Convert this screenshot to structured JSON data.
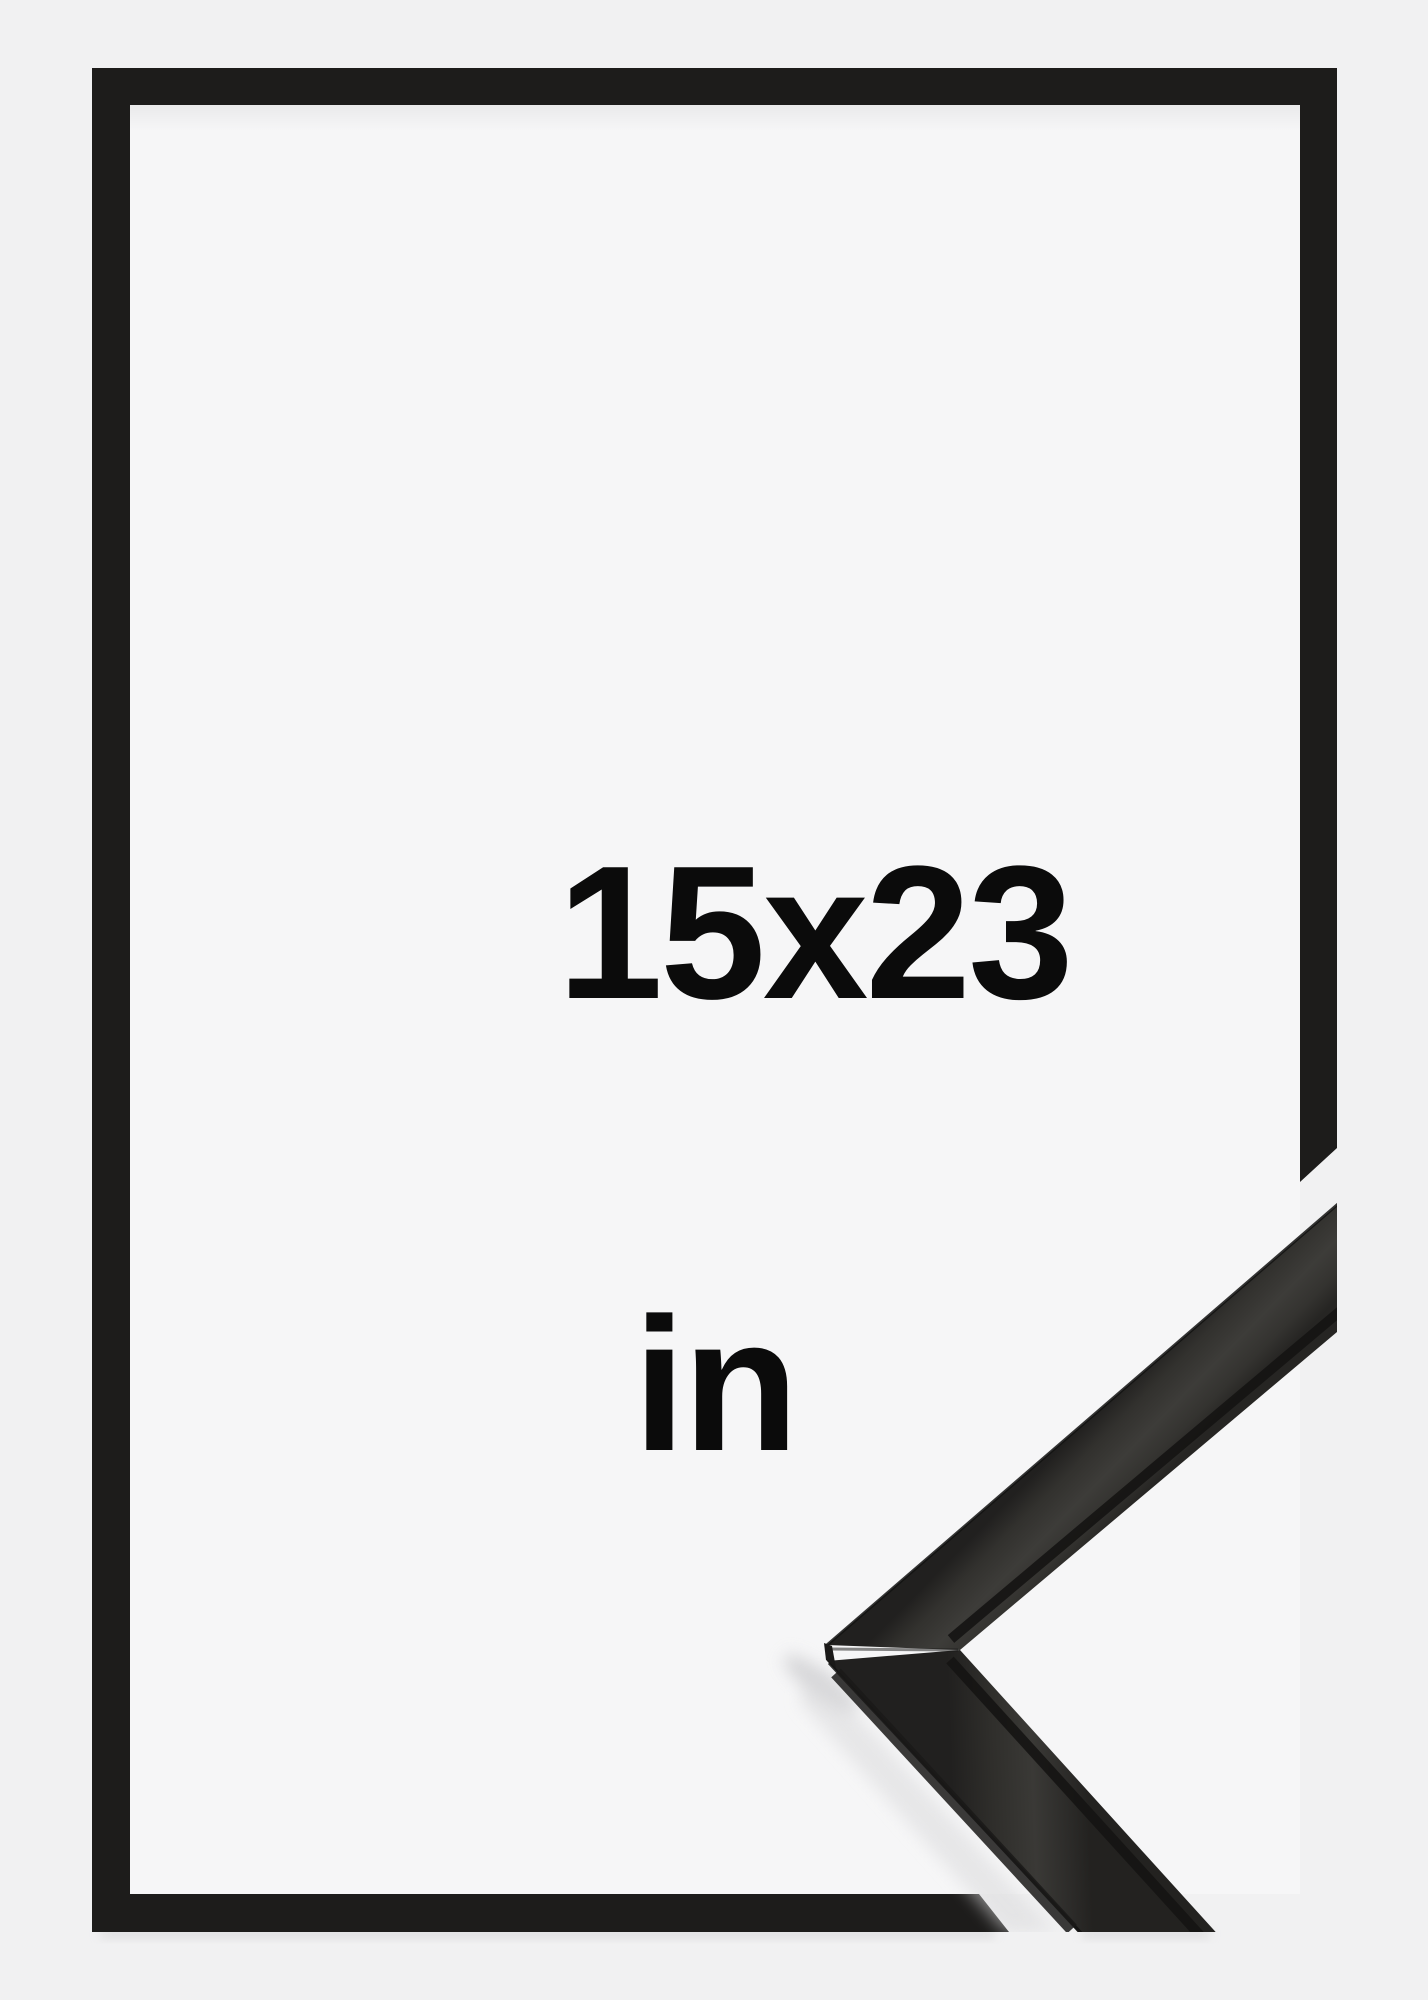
{
  "product": {
    "size_label": "15x23",
    "unit_label": "in",
    "description_of_graphic": "black picture frame outline with photographic corner sample of the black wooden moulding"
  },
  "colors": {
    "background": "#f1f1f2",
    "panel": "#f6f6f7",
    "frame_black": "#1d1c1b",
    "text_black": "#0b0b0b",
    "moulding_dark": "#21201f",
    "moulding_mid": "#3d3c39",
    "shadow_gray": "#d5d5d7"
  }
}
